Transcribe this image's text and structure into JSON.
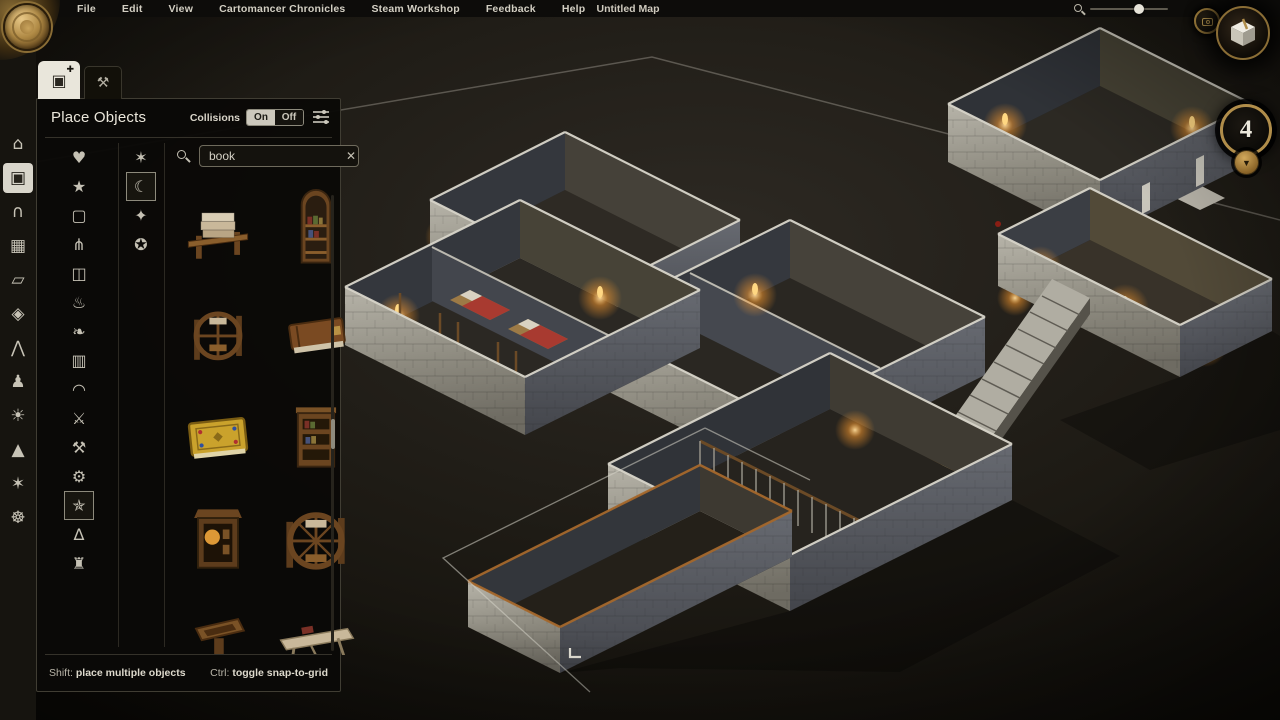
{
  "menu_bar": {
    "items": [
      "File",
      "Edit",
      "View",
      "Cartomancer Chronicles",
      "Steam Workshop",
      "Feedback",
      "Help"
    ],
    "map_title": "Untitled Map"
  },
  "view_controls": {
    "zoom_icon": "search-icon",
    "zoom_percent": 63,
    "camera_button": "camera-icon",
    "view_cube_button": "orientation-cube-icon"
  },
  "floor_selector": {
    "current_floor": "4",
    "collapse_icon": "▼"
  },
  "sidebar": {
    "tools": [
      {
        "name": "rooms-tool",
        "glyph": "⌂",
        "selected": false
      },
      {
        "name": "objects-tool",
        "glyph": "▣",
        "selected": true
      },
      {
        "name": "doors-tool",
        "glyph": "∩",
        "selected": false
      },
      {
        "name": "windows-tool",
        "glyph": "▦",
        "selected": false
      },
      {
        "name": "floors-tool",
        "glyph": "▱",
        "selected": false
      },
      {
        "name": "tiles-tool",
        "glyph": "◈",
        "selected": false
      },
      {
        "name": "roofs-tool",
        "glyph": "⋀",
        "selected": false
      },
      {
        "name": "characters-tool",
        "glyph": "♟",
        "selected": false
      },
      {
        "name": "lighting-tool",
        "glyph": "☀",
        "selected": false
      },
      {
        "name": "terrain-tool",
        "glyph": "▲",
        "selected": false
      },
      {
        "name": "effects-tool",
        "glyph": "✶",
        "selected": false
      },
      {
        "name": "compass-tool",
        "glyph": "☸",
        "selected": false
      }
    ]
  },
  "panel": {
    "tabs": [
      {
        "name": "tab-place-objects",
        "glyph": "▣",
        "badge_glyph": "✚",
        "active": true
      },
      {
        "name": "tab-edit-terrain",
        "glyph": "⚒",
        "active": false
      }
    ],
    "title": "Place Objects",
    "collisions": {
      "label": "Collisions",
      "on": "On",
      "off": "Off",
      "state": "On"
    },
    "filter_icon": "filter-sliders-icon",
    "search": {
      "icon": "search-icon",
      "value": "book",
      "clear_glyph": "✕"
    },
    "categories": [
      {
        "name": "category-favorites",
        "glyph": "♥",
        "selected": false
      },
      {
        "name": "category-new",
        "glyph": "★",
        "selected": false
      },
      {
        "name": "category-frames",
        "glyph": "▢",
        "selected": false
      },
      {
        "name": "category-kitchen",
        "glyph": "⋔",
        "selected": false
      },
      {
        "name": "category-furniture",
        "glyph": "◫",
        "selected": false
      },
      {
        "name": "category-lighting",
        "glyph": "♨",
        "selected": false
      },
      {
        "name": "category-plants",
        "glyph": "❧",
        "selected": false
      },
      {
        "name": "category-treasury",
        "glyph": "▥",
        "selected": false
      },
      {
        "name": "category-fireplaces",
        "glyph": "◠",
        "selected": false
      },
      {
        "name": "category-butchery",
        "glyph": "⚔",
        "selected": false
      },
      {
        "name": "category-smithy",
        "glyph": "⚒",
        "selected": false
      },
      {
        "name": "category-machines",
        "glyph": "⚙",
        "selected": false
      },
      {
        "name": "category-magic",
        "glyph": "✯",
        "selected": true
      },
      {
        "name": "category-illusions",
        "glyph": "∆",
        "selected": false
      },
      {
        "name": "category-ruins",
        "glyph": "♜",
        "selected": false
      }
    ],
    "subcategories": [
      {
        "name": "subcategory-magic-tables",
        "glyph": "✶",
        "selected": false
      },
      {
        "name": "subcategory-crystal-balls",
        "glyph": "☾",
        "selected": true
      },
      {
        "name": "subcategory-magic-frames",
        "glyph": "✦",
        "selected": false
      },
      {
        "name": "subcategory-magic-pedestals",
        "glyph": "✪",
        "selected": false
      }
    ],
    "objects": [
      {
        "name": "object-book-stack-stand",
        "thumb": "book-stand"
      },
      {
        "name": "object-arched-bookcase",
        "thumb": "arched-shelf"
      },
      {
        "name": "object-book-wheel-small",
        "thumb": "wheel-sm"
      },
      {
        "name": "object-closed-tome",
        "thumb": "closed-book"
      },
      {
        "name": "object-golden-tome",
        "thumb": "gold-book"
      },
      {
        "name": "object-bookshelf-tower",
        "thumb": "shelf-tower"
      },
      {
        "name": "object-book-cabinet",
        "thumb": "cabinet-lamp"
      },
      {
        "name": "object-book-wheel-large",
        "thumb": "wheel-lg"
      },
      {
        "name": "object-lectern",
        "thumb": "lectern"
      },
      {
        "name": "object-book-bench",
        "thumb": "bench"
      }
    ],
    "hints": {
      "shift_key": "Shift:",
      "shift_text": "place multiple objects",
      "ctrl_key": "Ctrl:",
      "ctrl_text": "toggle snap-to-grid"
    }
  }
}
